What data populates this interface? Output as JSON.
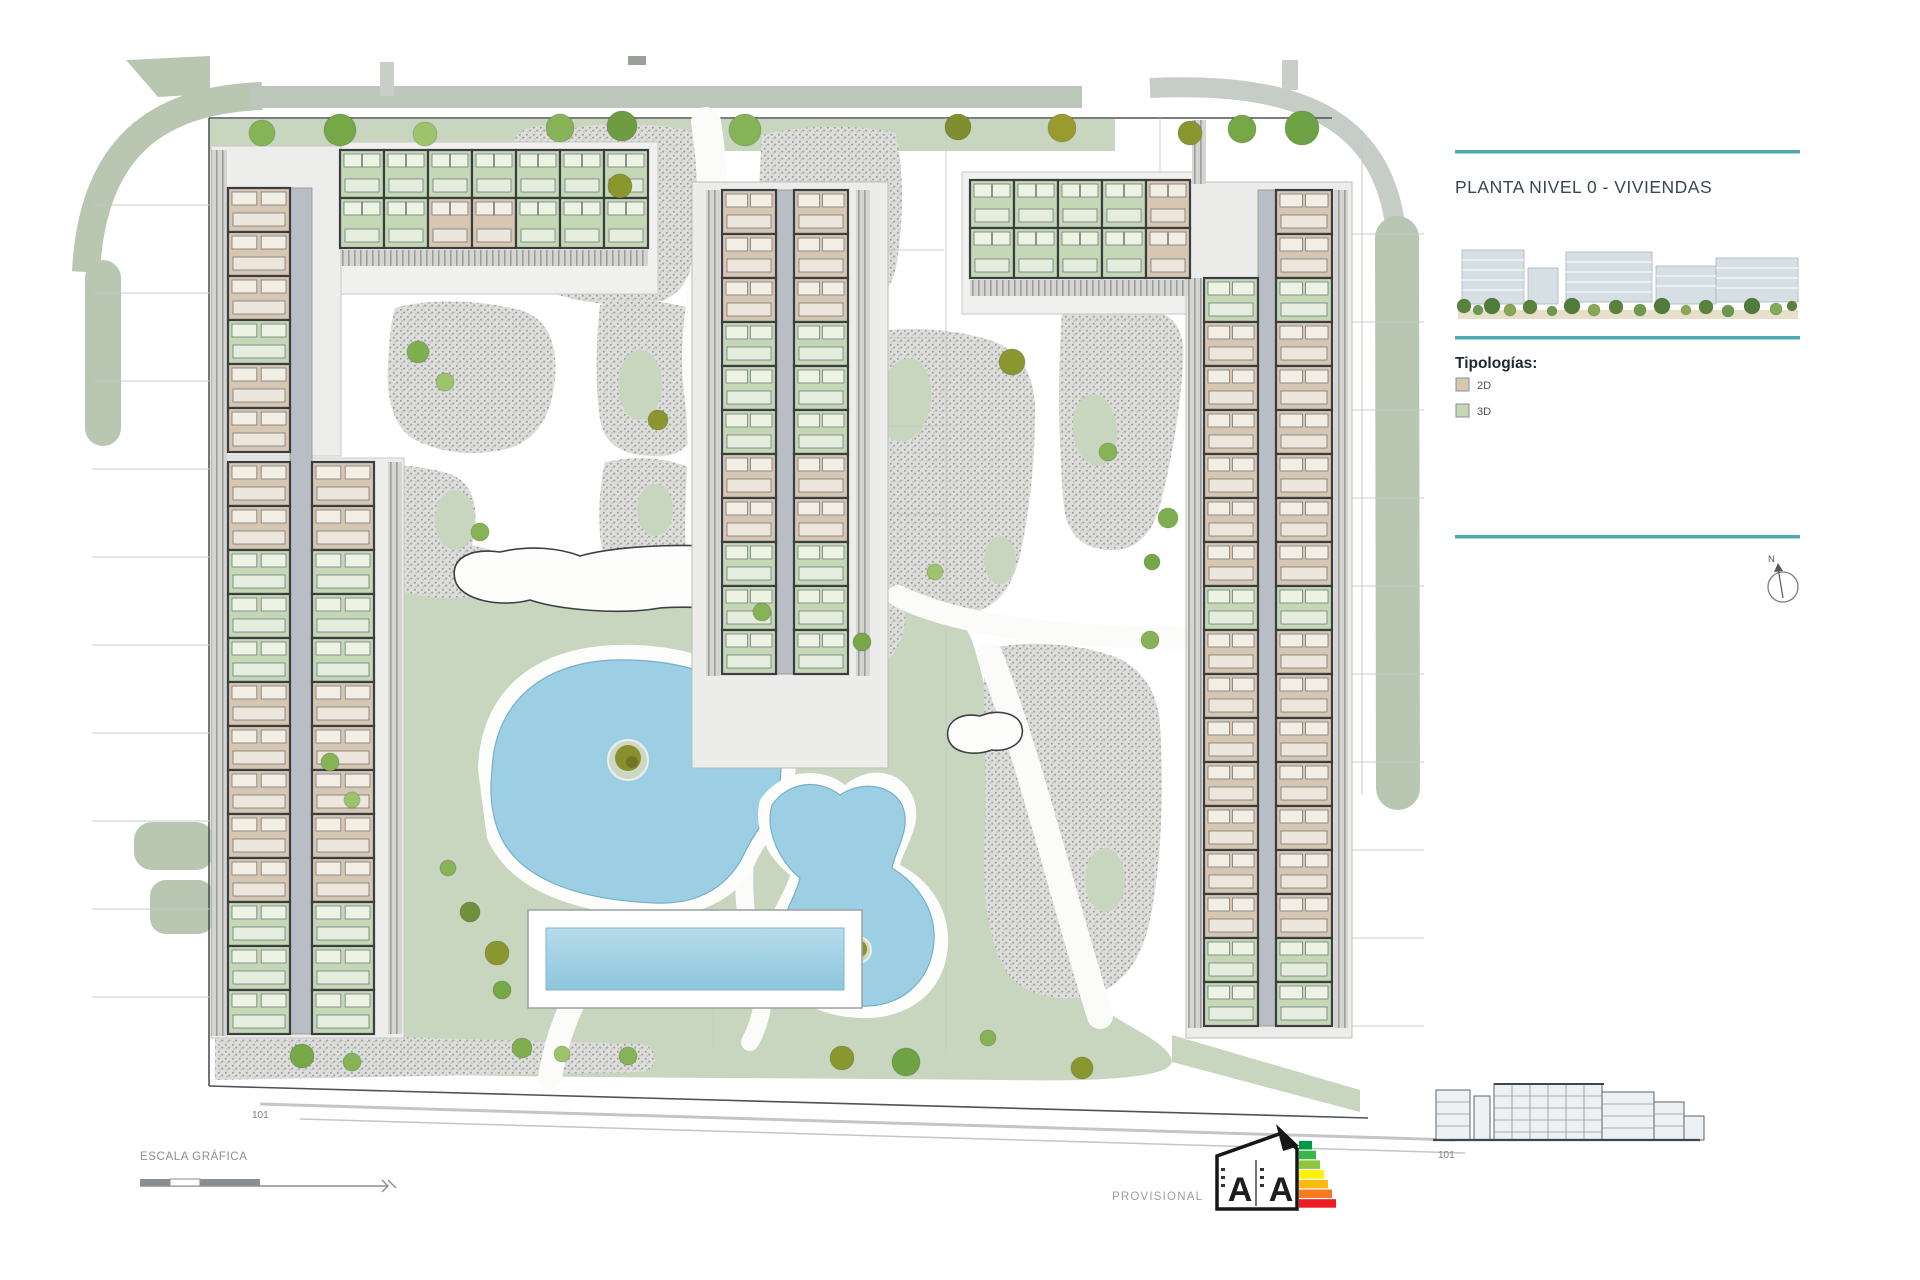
{
  "panel": {
    "title": "PLANTA NIVEL 0 - VIVIENDAS",
    "legend_title": "Tipologías:",
    "legend": [
      {
        "label": "2D",
        "color": "#d7c7b2"
      },
      {
        "label": "3D",
        "color": "#c4d8b6"
      }
    ],
    "accent_color": "#4fa9ad"
  },
  "compass": {
    "label": "N"
  },
  "annotations": {
    "scale_label": "ESCALA GRÁFICA",
    "provisional": "PROVISIONAL",
    "plan_ref": "101",
    "elevation_ref": "101"
  },
  "energy": {
    "letters": [
      "A",
      "A"
    ],
    "colors": [
      "#009a44",
      "#39b54a",
      "#8dc63f",
      "#fff200",
      "#fdb913",
      "#f47b20",
      "#ed1c24"
    ]
  },
  "plan": {
    "colors": {
      "road": "#b9c6b1",
      "lawn": "#c9d6bf",
      "gravel_base": "#dddddb",
      "gravel_dot": "#9b9b98",
      "pool": "#9ccfe3",
      "boundary": "#4d5357"
    }
  }
}
